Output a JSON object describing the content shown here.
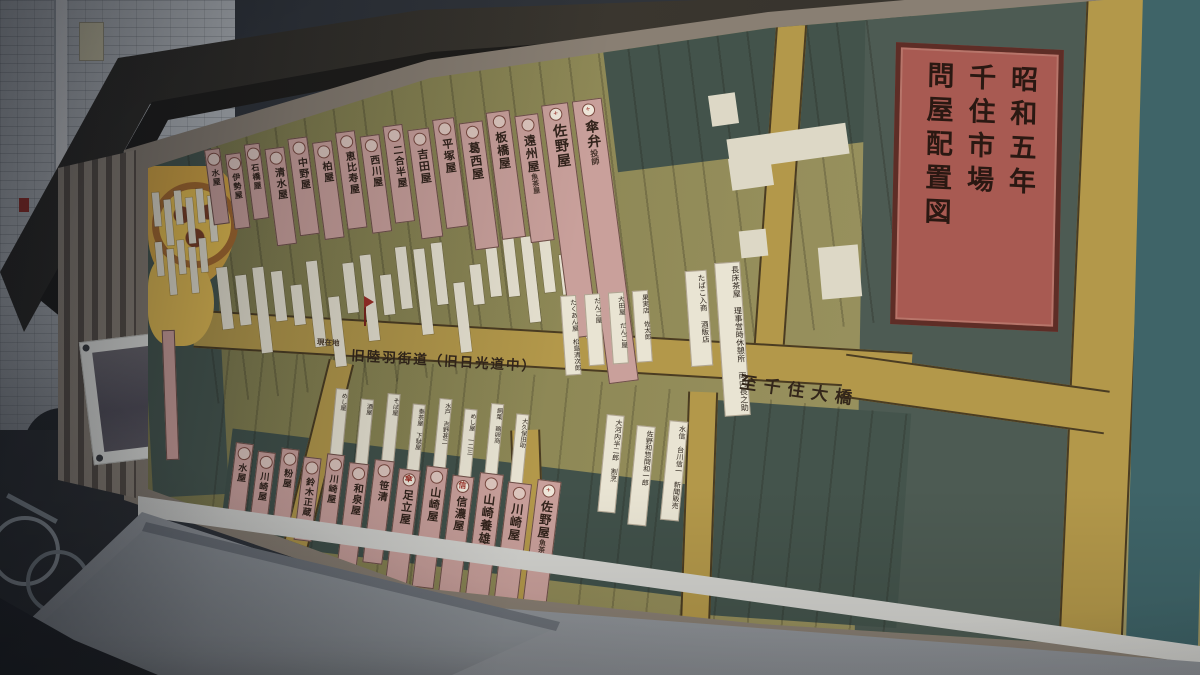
{
  "map": {
    "title_plate_lines": [
      "昭和五年",
      "千住市場",
      "問屋配置図"
    ],
    "roads": {
      "highway": "旧陸羽街道（旧日光道中）",
      "to_bridge": "至千住大橋",
      "current_location": "現在地"
    },
    "top_shops": [
      {
        "name": "水屋",
        "mark": ""
      },
      {
        "name": "伊勢屋",
        "mark": ""
      },
      {
        "name": "石橋屋",
        "mark": ""
      },
      {
        "name": "清水屋",
        "mark": ""
      },
      {
        "name": "中野屋",
        "mark": ""
      },
      {
        "name": "柏屋",
        "mark": ""
      },
      {
        "name": "恵比寿屋",
        "mark": ""
      },
      {
        "name": "西川屋",
        "mark": ""
      },
      {
        "name": "二合半屋",
        "mark": ""
      },
      {
        "name": "吉田屋",
        "mark": ""
      },
      {
        "name": "平塚屋",
        "mark": ""
      },
      {
        "name": "葛西屋",
        "mark": ""
      },
      {
        "name": "板橋屋",
        "mark": ""
      },
      {
        "name": "遠州屋",
        "sub": "魚茶屋",
        "mark": ""
      },
      {
        "name": "佐野屋",
        "mark": "+"
      },
      {
        "name": "傘弁",
        "sub": "投師",
        "mark": "+"
      }
    ],
    "bottom_shops": [
      {
        "name": "水屋",
        "mark": ""
      },
      {
        "name": "川崎屋",
        "mark": ""
      },
      {
        "name": "粉屋",
        "mark": ""
      },
      {
        "name": "鈴木正蔵",
        "mark": ""
      },
      {
        "name": "川崎屋",
        "mark": ""
      },
      {
        "name": "和泉屋",
        "mark": ""
      },
      {
        "name": "笹清",
        "mark": ""
      },
      {
        "name": "足立屋",
        "mark": "傘"
      },
      {
        "name": "山崎屋",
        "mark": ""
      },
      {
        "name": "信濃屋",
        "mark": "信三"
      },
      {
        "name": "山崎養雄",
        "mark": ""
      },
      {
        "name": "川崎屋",
        "mark": ""
      },
      {
        "name": "佐野屋",
        "sub": "魚茶屋",
        "mark": "+"
      }
    ],
    "upper_right_labels": [
      "たくあん屋 松島清次郎",
      "だんご屋",
      "大田屋 だんご屋",
      "果実店 佐太郎",
      "たばこ入商 酒販店",
      "長床茶屋 理事営時休憩所 両内長之助"
    ],
    "lower_labels": [
      "めし屋",
      "酒屋",
      "そば屋",
      "泰茶屋 下駄屋",
      "水戸 吉野甚二",
      "めし屋 一二三",
      "飼葉 鶏卵商",
      "大久保田助",
      "大河内半二郎 割烹",
      "佐野和惣問和一郎",
      "水信 台川信一 新聞販売"
    ],
    "colors": {
      "lot_olive": "#8a8552",
      "road_mustard": "#b3984a",
      "block_slate": "#46564e",
      "river_teal": "#3f6468",
      "label_pink": "#c9a09b",
      "title_red": "#a85a52",
      "paper": "#e6e1d0"
    }
  }
}
